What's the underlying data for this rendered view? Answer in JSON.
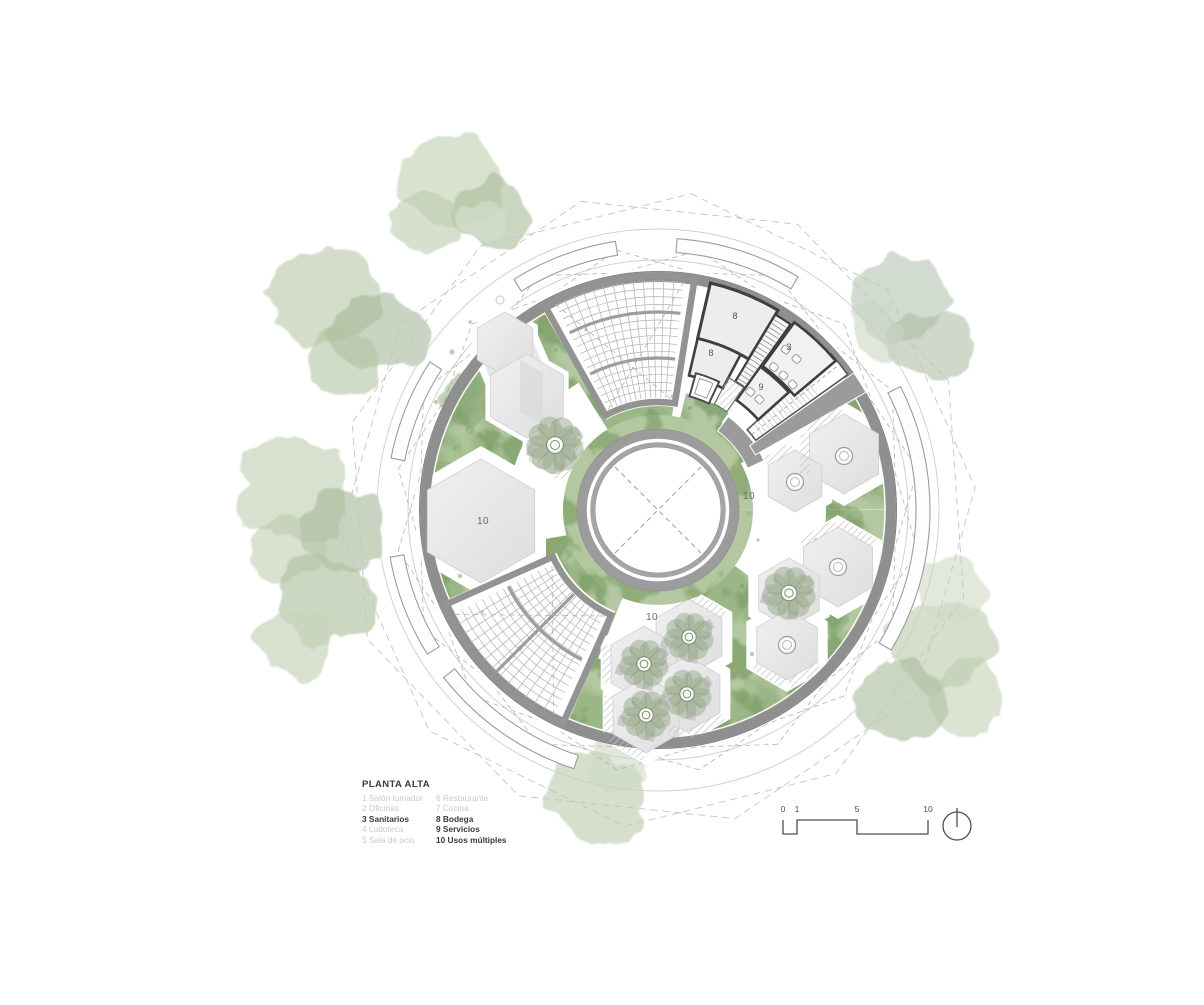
{
  "legend": {
    "title": "PLANTA ALTA",
    "columns": [
      [
        {
          "text": "1 Salón fumador"
        },
        {
          "text": "2 Oficinas"
        },
        {
          "text": "3 Sanitarios"
        },
        {
          "text": "4 Ludoteca"
        },
        {
          "text": "5 Sala de ocio"
        }
      ],
      [
        {
          "text": "6 Restaurante"
        },
        {
          "text": "7 Cocina"
        },
        {
          "text": "8 Bodega"
        },
        {
          "text": "9 Servicios"
        },
        {
          "text": "10 Usos múltiples"
        }
      ]
    ]
  },
  "plan_labels": {
    "storage_upper": "8",
    "storage_lower": "8",
    "restrooms": "3",
    "services": "9",
    "multipurpose_left": "10",
    "multipurpose_right": "10",
    "multipurpose_bottom": "10"
  },
  "scale_bar": {
    "ticks": [
      "0",
      "1",
      "5",
      "10"
    ]
  },
  "colors": {
    "green_base": "#b3c8a1",
    "green_mid": "#9ab786",
    "green_dark": "#7fa069",
    "green_light": "#cfdcc0",
    "band_gray": "#8f8f8f",
    "wall_dark": "#3e3e3e",
    "hex_fill": "#e9e9eb",
    "hex_shade": "#d9d9db",
    "line_light": "#c9c9c9",
    "dash_gray": "#b3b3b3",
    "ink": "#4d4d4d"
  }
}
